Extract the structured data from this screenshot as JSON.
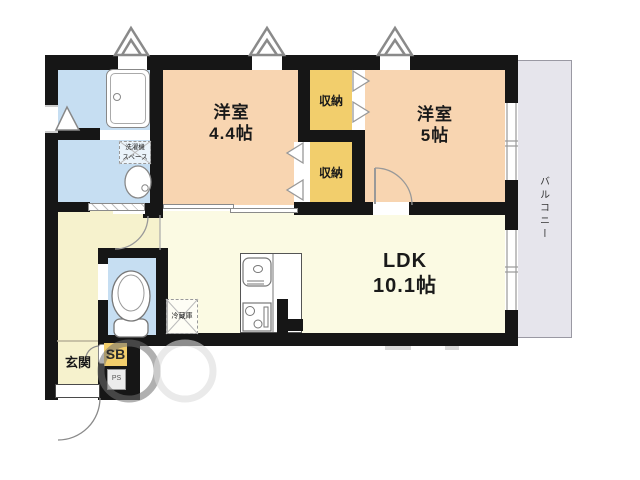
{
  "floorplan": {
    "labels": {
      "room1_name": "洋室",
      "room1_size": "4.4帖",
      "room2_name": "洋室",
      "room2_size": "5帖",
      "ldk_name": "LDK",
      "ldk_size": "10.1帖",
      "closet_top": "収納",
      "closet_bottom": "収納",
      "balcony": "バルコニー",
      "entrance": "玄関",
      "washer_line1": "洗濯機",
      "washer_line2": "スペース",
      "refrigerator": "冷蔵庫",
      "sb": "SB",
      "ps": "PS"
    },
    "colors": {
      "wall": "#161616",
      "room_peach": "#f8d5b1",
      "closet_yellow": "#f2ce6c",
      "ldk_cream": "#fbfae3",
      "hall_cream": "#f6f2cd",
      "water_blue": "#c6def2",
      "balcony_gray": "#e6e5ec",
      "line_gray": "#8a8a8a"
    }
  }
}
